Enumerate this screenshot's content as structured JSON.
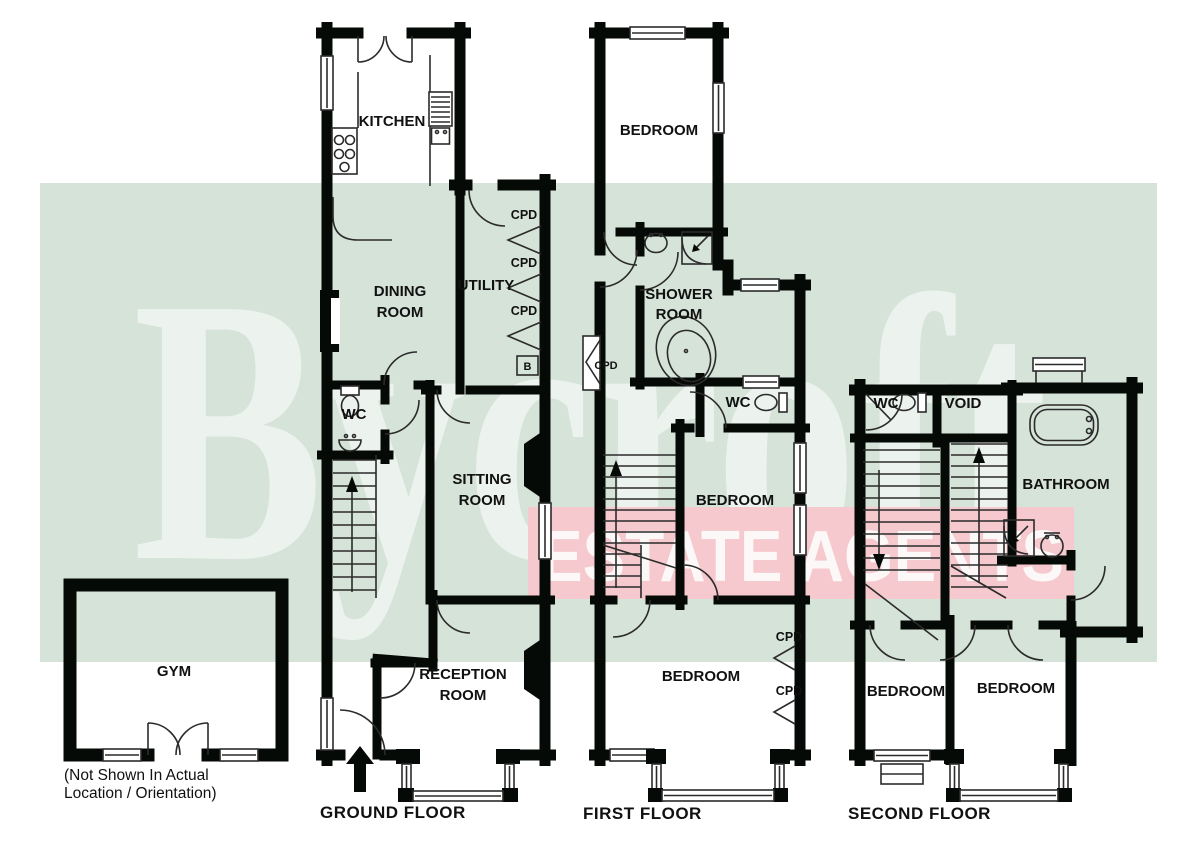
{
  "watermark": {
    "brand": "Bycroft",
    "tagline": "ESTATE AGENTS",
    "green_band_color": "#d6e3d9",
    "pink_band_color": "#f5c9cd"
  },
  "ground_floor": {
    "title": "GROUND FLOOR",
    "labels": {
      "kitchen": "KITCHEN",
      "dining": [
        "DINING",
        "ROOM"
      ],
      "utility": "UTILITY",
      "cpd1": "CPD",
      "cpd2": "CPD",
      "cpd3": "CPD",
      "boiler": "B",
      "wc": "WC",
      "sitting": [
        "SITTING",
        "ROOM"
      ],
      "reception": [
        "RECEPTION",
        "ROOM"
      ]
    }
  },
  "first_floor": {
    "title": "FIRST FLOOR",
    "labels": {
      "bedroom_top": "BEDROOM",
      "shower": [
        "SHOWER",
        "ROOM"
      ],
      "cpd_landing": "CPD",
      "wc": "WC",
      "bedroom_middle": "BEDROOM",
      "bedroom_bottom": "BEDROOM",
      "cpd1": "CPD",
      "cpd2": "CPD"
    }
  },
  "second_floor": {
    "title": "SECOND FLOOR",
    "labels": {
      "wc": "WC",
      "void": "VOID",
      "bathroom": "BATHROOM",
      "bedroom_left": "BEDROOM",
      "bedroom_right": "BEDROOM"
    }
  },
  "gym": {
    "label": "GYM",
    "note": [
      "(Not Shown In Actual",
      "Location / Orientation)"
    ]
  }
}
